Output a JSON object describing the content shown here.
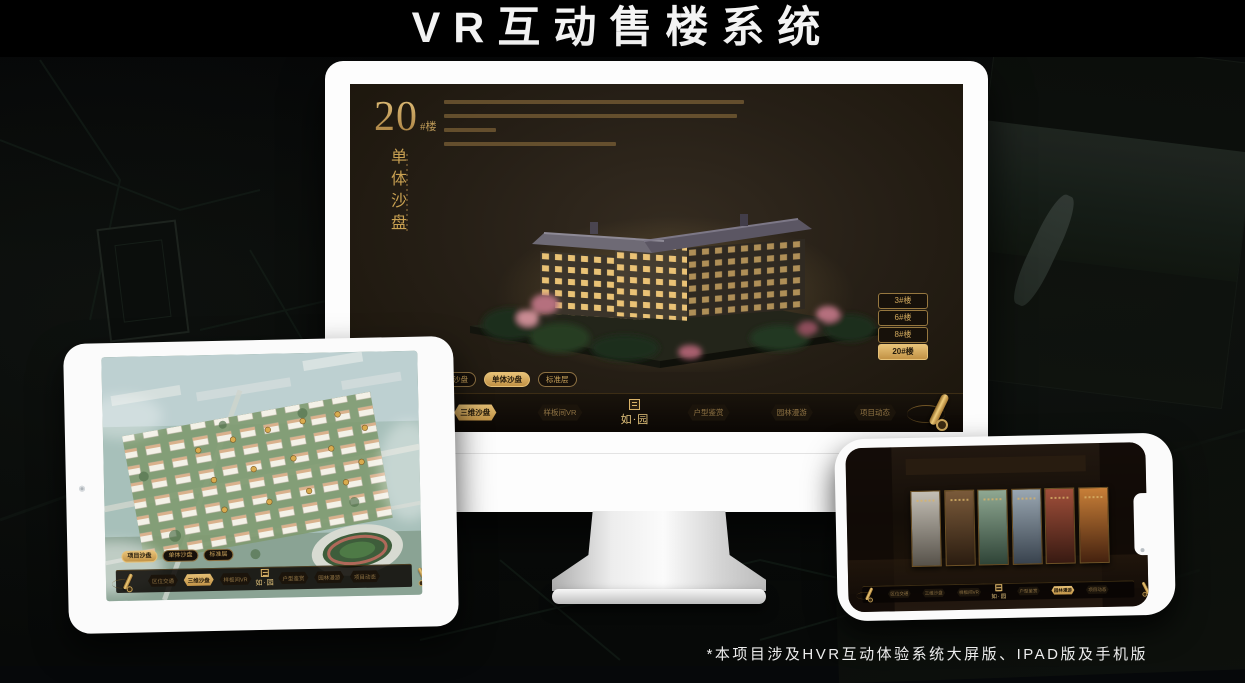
{
  "page": {
    "title": "VR互动售楼系统",
    "footnote": "*本项目涉及HVR互动体验系统大屏版、IPAD版及手机版"
  },
  "colors": {
    "gold": "#c9a152",
    "gold_bright": "#e7c278",
    "gold_dim": "#8f7344",
    "screen_bg": "#261f16",
    "navbar_bg": "#0b0704",
    "device_white": "#fbfbfb"
  },
  "monitor": {
    "hero": {
      "number": "20",
      "suffix": "#楼",
      "vertical": "单体沙盘"
    },
    "building_buttons": [
      {
        "label": "3#楼",
        "active": false
      },
      {
        "label": "6#楼",
        "active": false
      },
      {
        "label": "8#楼",
        "active": false
      },
      {
        "label": "20#楼",
        "active": true
      }
    ],
    "tabs": [
      {
        "label": "项目沙盘",
        "active": false
      },
      {
        "label": "单体沙盘",
        "active": true
      },
      {
        "label": "标准层",
        "active": false
      }
    ],
    "nav": {
      "items": [
        {
          "label": "区位交通",
          "active": false
        },
        {
          "label": "三维沙盘",
          "active": true
        },
        {
          "label": "样板间VR",
          "active": false
        },
        {
          "label": "户型鉴赏",
          "active": false
        },
        {
          "label": "园林漫游",
          "active": false
        },
        {
          "label": "项目动态",
          "active": false
        }
      ],
      "logo": "如·园"
    }
  },
  "tablet": {
    "tabs": [
      {
        "label": "项目沙盘",
        "active": true
      },
      {
        "label": "单体沙盘",
        "active": false
      },
      {
        "label": "标准层",
        "active": false
      }
    ],
    "nav": {
      "items": [
        {
          "label": "区位交通",
          "active": false
        },
        {
          "label": "三维沙盘",
          "active": true
        },
        {
          "label": "样板间VR",
          "active": false
        },
        {
          "label": "户型鉴赏",
          "active": false
        },
        {
          "label": "园林漫游",
          "active": false
        },
        {
          "label": "项目动态",
          "active": false
        }
      ],
      "logo": "如·园"
    }
  },
  "phone": {
    "nav": {
      "items": [
        {
          "label": "区位交通",
          "active": false
        },
        {
          "label": "三维沙盘",
          "active": false
        },
        {
          "label": "样板间VR",
          "active": false
        },
        {
          "label": "户型鉴赏",
          "active": false
        },
        {
          "label": "园林漫游",
          "active": true
        },
        {
          "label": "项目动态",
          "active": false
        }
      ],
      "logo": "如·园"
    },
    "panels": [
      {
        "name": "grey-courtyard",
        "c1": "#c4bfb5",
        "c2": "#57524a"
      },
      {
        "name": "interior-lobby",
        "c1": "#7a5a3a",
        "c2": "#2a1c10"
      },
      {
        "name": "garden-pavilion",
        "c1": "#8fa892",
        "c2": "#2f4437"
      },
      {
        "name": "building-facade",
        "c1": "#9aa7b2",
        "c2": "#39434e"
      },
      {
        "name": "autumn-courtyard",
        "c1": "#a04f3a",
        "c2": "#381a12"
      },
      {
        "name": "lit-shelves",
        "c1": "#c87f38",
        "c2": "#45220f"
      }
    ]
  }
}
